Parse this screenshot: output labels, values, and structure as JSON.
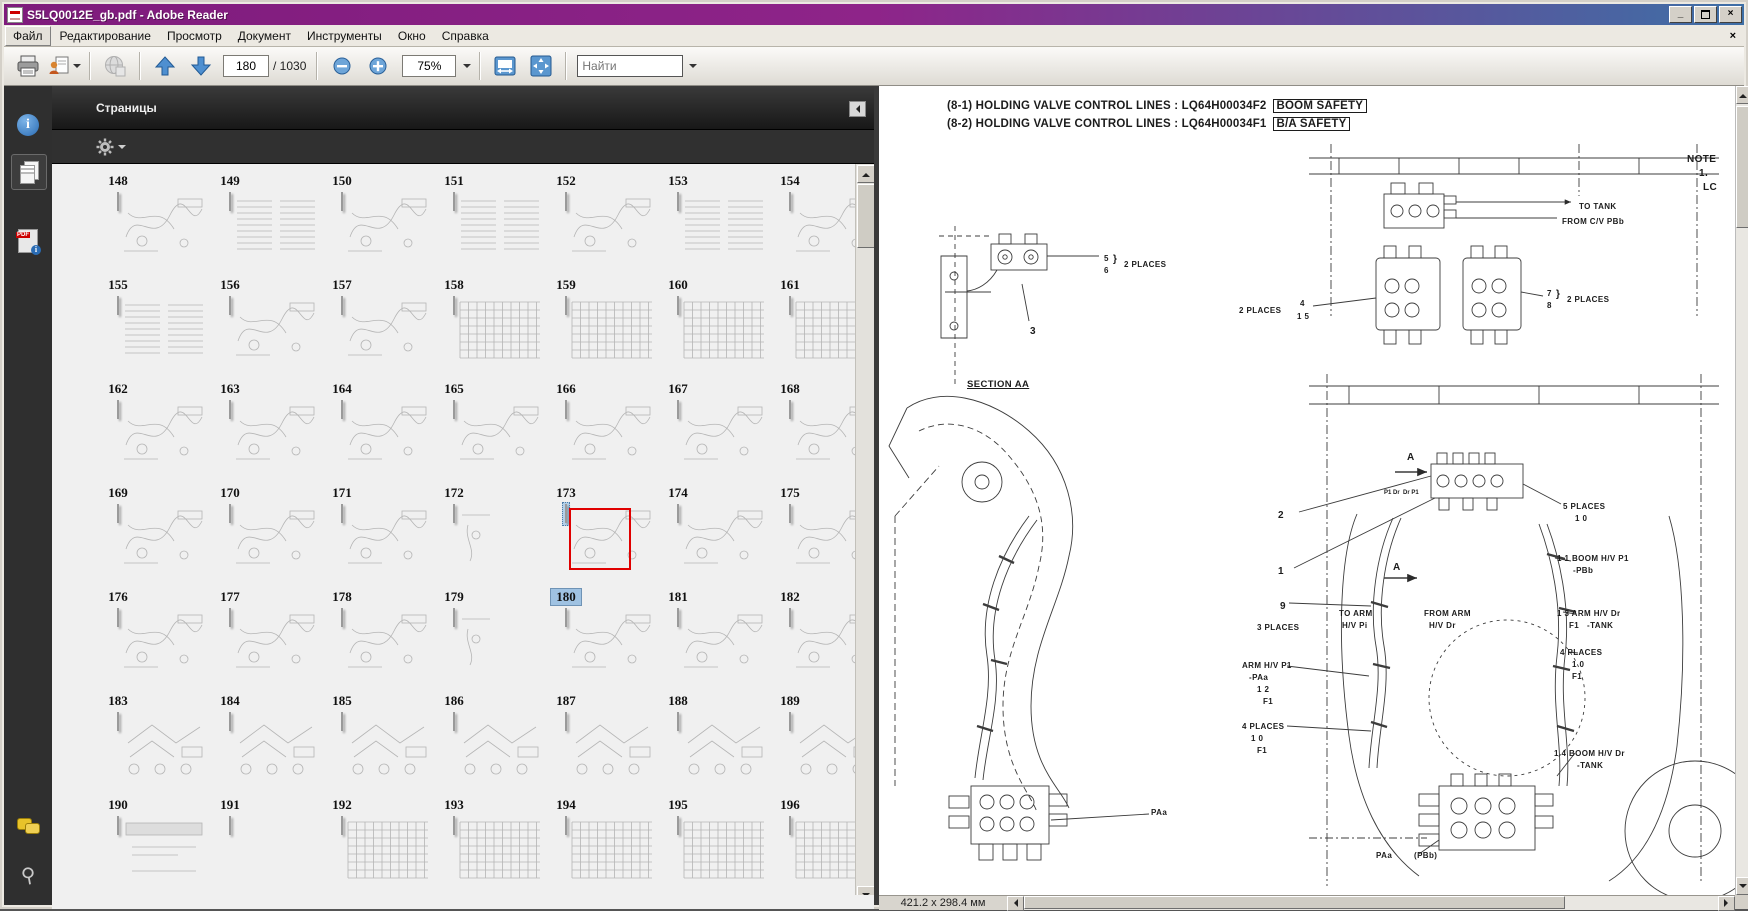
{
  "window": {
    "title": "S5LQ0012E_gb.pdf - Adobe Reader",
    "controls": {
      "minimize": "_",
      "restore": "restore",
      "close": "×"
    }
  },
  "menu_bar": {
    "items": [
      "Файл",
      "Редактирование",
      "Просмотр",
      "Документ",
      "Инструменты",
      "Окно",
      "Справка"
    ],
    "active_item": "Файл",
    "document_close": "×"
  },
  "toolbar": {
    "page_field_value": "180",
    "page_total": "/ 1030",
    "zoom_value": "75%",
    "search_placeholder": "Найти"
  },
  "nav_rail": {
    "icons": [
      "info-icon",
      "pages-icon",
      "pdf-info-icon",
      "comments-icon",
      "attachment-icon"
    ]
  },
  "pages_panel": {
    "title": "Страницы",
    "selected_page": "180",
    "label_rows": [
      [
        "148",
        "149",
        "150",
        "151",
        "152",
        "153",
        "154"
      ],
      [
        "155",
        "156",
        "157",
        "158",
        "159",
        "160",
        "161"
      ],
      [
        "162",
        "163",
        "164",
        "165",
        "166",
        "167",
        "168"
      ],
      [
        "169",
        "170",
        "171",
        "172",
        "173",
        "174",
        "175"
      ],
      [
        "176",
        "177",
        "178",
        "179",
        "180",
        "181",
        "182"
      ],
      [
        "183",
        "184",
        "185",
        "186",
        "187",
        "188",
        "189"
      ],
      [
        "190",
        "191",
        "192",
        "193",
        "194",
        "195",
        "196"
      ]
    ],
    "thumb_rows": [
      [
        "diag",
        "text",
        "diag",
        "text",
        "diag",
        "text",
        "diag"
      ],
      [
        "text",
        "diag",
        "diag",
        "table",
        "table",
        "table",
        "table"
      ],
      [
        "diag",
        "diag",
        "diag",
        "diag",
        "diag",
        "diag",
        "diag"
      ],
      [
        "diag",
        "diag",
        "diag",
        "sparse",
        "diag",
        "diag",
        "diag"
      ],
      [
        "diag",
        "diag",
        "diag",
        "sparse",
        "diag",
        "diag",
        "diag"
      ],
      [
        "parts",
        "parts",
        "parts",
        "parts",
        "parts",
        "parts",
        "parts"
      ],
      [
        "cover",
        "blank",
        "table",
        "table",
        "table",
        "table",
        "table"
      ]
    ],
    "selected": {
      "thumb_row": 3,
      "col": 4,
      "label_row": 4
    }
  },
  "document": {
    "headings": [
      {
        "text": "(8-1) HOLDING VALVE CONTROL LINES : LQ64H00034F2",
        "tag": "BOOM SAFETY"
      },
      {
        "text": "(8-2) HOLDING VALVE CONTROL LINES : LQ64H00034F1",
        "tag": "B/A SAFETY"
      }
    ],
    "diagram_labels": [
      {
        "t": "NOTE",
        "x": 808,
        "y": 68,
        "cls": "big"
      },
      {
        "t": "1.",
        "x": 820,
        "y": 82,
        "cls": "big"
      },
      {
        "t": "LC",
        "x": 824,
        "y": 96,
        "cls": "big"
      },
      {
        "t": "TO TANK",
        "x": 700,
        "y": 116
      },
      {
        "t": "FROM C/V PBb",
        "x": 683,
        "y": 131
      },
      {
        "t": "5",
        "x": 225,
        "y": 168
      },
      {
        "t": "6",
        "x": 225,
        "y": 180
      },
      {
        "t": "}",
        "x": 234,
        "y": 168,
        "cls": "big"
      },
      {
        "t": "2 PLACES",
        "x": 245,
        "y": 174
      },
      {
        "t": "7",
        "x": 668,
        "y": 203
      },
      {
        "t": "8",
        "x": 668,
        "y": 215
      },
      {
        "t": "}",
        "x": 677,
        "y": 203,
        "cls": "big"
      },
      {
        "t": "2 PLACES",
        "x": 688,
        "y": 209
      },
      {
        "t": "2 PLACES",
        "x": 360,
        "y": 220
      },
      {
        "t": "4",
        "x": 421,
        "y": 213
      },
      {
        "t": "1 5",
        "x": 418,
        "y": 226
      },
      {
        "t": "3",
        "x": 151,
        "y": 240,
        "cls": "big"
      },
      {
        "t": "SECTION AA",
        "x": 88,
        "y": 294,
        "cls": "u"
      },
      {
        "t": "A",
        "x": 528,
        "y": 366,
        "cls": "big"
      },
      {
        "t": "P1 Dr  Dr P1",
        "x": 505,
        "y": 404,
        "cls": "sm"
      },
      {
        "t": "5 PLACES",
        "x": 684,
        "y": 416
      },
      {
        "t": "1 0",
        "x": 696,
        "y": 428
      },
      {
        "t": "2",
        "x": 399,
        "y": 424,
        "cls": "big"
      },
      {
        "t": "1",
        "x": 399,
        "y": 480,
        "cls": "big"
      },
      {
        "t": "A",
        "x": 514,
        "y": 476,
        "cls": "big"
      },
      {
        "t": "1 1 BOOM H/V P1",
        "x": 678,
        "y": 468
      },
      {
        "t": "-PBb",
        "x": 694,
        "y": 480
      },
      {
        "t": "9",
        "x": 401,
        "y": 515,
        "cls": "big"
      },
      {
        "t": "3 PLACES",
        "x": 378,
        "y": 537
      },
      {
        "t": "TO ARM",
        "x": 460,
        "y": 523
      },
      {
        "t": "H/V Pi",
        "x": 463,
        "y": 535
      },
      {
        "t": "FROM ARM",
        "x": 545,
        "y": 523
      },
      {
        "t": "H/V Dr",
        "x": 550,
        "y": 535
      },
      {
        "t": "1 3 ARM H/V Dr",
        "x": 678,
        "y": 523
      },
      {
        "t": "F1   -TANK",
        "x": 690,
        "y": 535
      },
      {
        "t": "4 PLACES",
        "x": 681,
        "y": 562
      },
      {
        "t": "1 0",
        "x": 693,
        "y": 574
      },
      {
        "t": "F1",
        "x": 693,
        "y": 586
      },
      {
        "t": "ARM H/V P1",
        "x": 363,
        "y": 575
      },
      {
        "t": "-PAa",
        "x": 370,
        "y": 587
      },
      {
        "t": "1 2",
        "x": 378,
        "y": 599
      },
      {
        "t": "F1",
        "x": 384,
        "y": 611
      },
      {
        "t": "4 PLACES",
        "x": 363,
        "y": 636
      },
      {
        "t": "1 0",
        "x": 372,
        "y": 648
      },
      {
        "t": "F1",
        "x": 378,
        "y": 660
      },
      {
        "t": "1 4 BOOM H/V Dr",
        "x": 675,
        "y": 663
      },
      {
        "t": "-TANK",
        "x": 698,
        "y": 675
      },
      {
        "t": "PAa",
        "x": 272,
        "y": 722
      },
      {
        "t": "PAa",
        "x": 497,
        "y": 765
      },
      {
        "t": "(PBb)",
        "x": 535,
        "y": 765
      }
    ],
    "status_bar": {
      "page_size": "421.2 x 298.4 мм"
    }
  }
}
